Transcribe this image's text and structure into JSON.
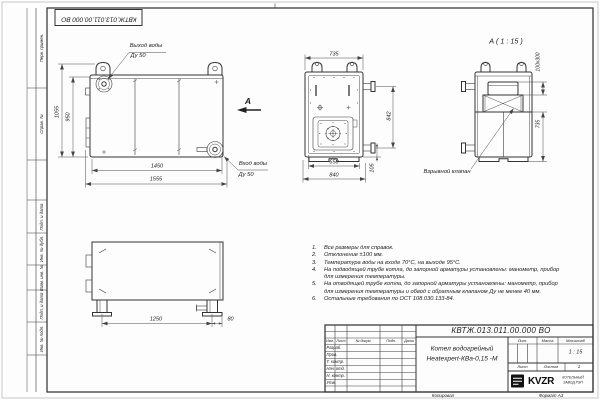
{
  "frame": {
    "top_stamp": "КВТЖ.013.011.00.000 ВО",
    "side_labels": [
      "Перв. примен.",
      "Справ. №",
      "Подп. и дата",
      "Инв. № дубл.",
      "Взам. инв. №",
      "Подп. и дата",
      "Инв. № подл."
    ],
    "footer": {
      "copied": "Копировал",
      "format": "Формат А3"
    }
  },
  "views": {
    "side": {
      "outlet_line1": "Выход воды",
      "outlet_line2": "Ду 50",
      "inlet_line1": "Вход воды",
      "inlet_line2": "Ду 50",
      "section_letter": "А",
      "dims": {
        "height_overall": "1055",
        "height_body": "950",
        "length_body": "1450",
        "length_overall": "1555"
      }
    },
    "front": {
      "dims": {
        "width_top": "735",
        "width_inner": "650",
        "width_overall": "840",
        "flange_height": "842",
        "bottom": "105"
      }
    },
    "rear": {
      "title": "А ( 1 : 15 )",
      "valve_label": "Взрывной клапан",
      "dims": {
        "valve_size": "100х300",
        "lower_height": "735"
      }
    },
    "plan": {
      "dims": {
        "feet_spacing": "1250",
        "edge_offset": "80"
      }
    }
  },
  "notes": {
    "items": [
      {
        "num": "1.",
        "text": "Все размеры для справок."
      },
      {
        "num": "2.",
        "text": "Отклонение ±100 мм."
      },
      {
        "num": "3.",
        "text": "Температура воды на входе 70°С, на выходе 95°С."
      },
      {
        "num": "4.",
        "text": "На подводящей трубе котла, до запорной арматуры установлены: манометр, прибор для измерения температуры."
      },
      {
        "num": "5.",
        "text": "На отводящей трубе котла, до запорной арматуры установлены: манометр, прибор для измерения температуры и обвод с обратным клапаном Ду не менее 40 мм."
      },
      {
        "num": "6.",
        "text": "Остальные требования по ОСТ 108.030.133-84."
      }
    ]
  },
  "title_block": {
    "doc_number": "КВТЖ.013.011.00.000 ВО",
    "name_line1": "Котел водогрейный",
    "name_line2": "Heatexpert-КВа-0,15 -М",
    "cols": {
      "izm": "Изм.",
      "list": "Лист",
      "doc": "№ докум.",
      "podp": "Подп.",
      "data": "Дата"
    },
    "rows": [
      "Разраб.",
      "Пров.",
      "Т. контр.",
      "Нач. отд.",
      "Н. контр.",
      "Утв."
    ],
    "lit_label": "Лит.",
    "mass_label": "Масса",
    "scale_label": "Масштаб",
    "scale_value": "1 : 15",
    "sheet_label": "Лист",
    "sheets_label": "Листов",
    "sheets_value": "1",
    "brand": "KVZR",
    "brand_line1": "КОТЕЛЬНЫЙ",
    "brand_line2": "ЗАВОД РЭП"
  }
}
